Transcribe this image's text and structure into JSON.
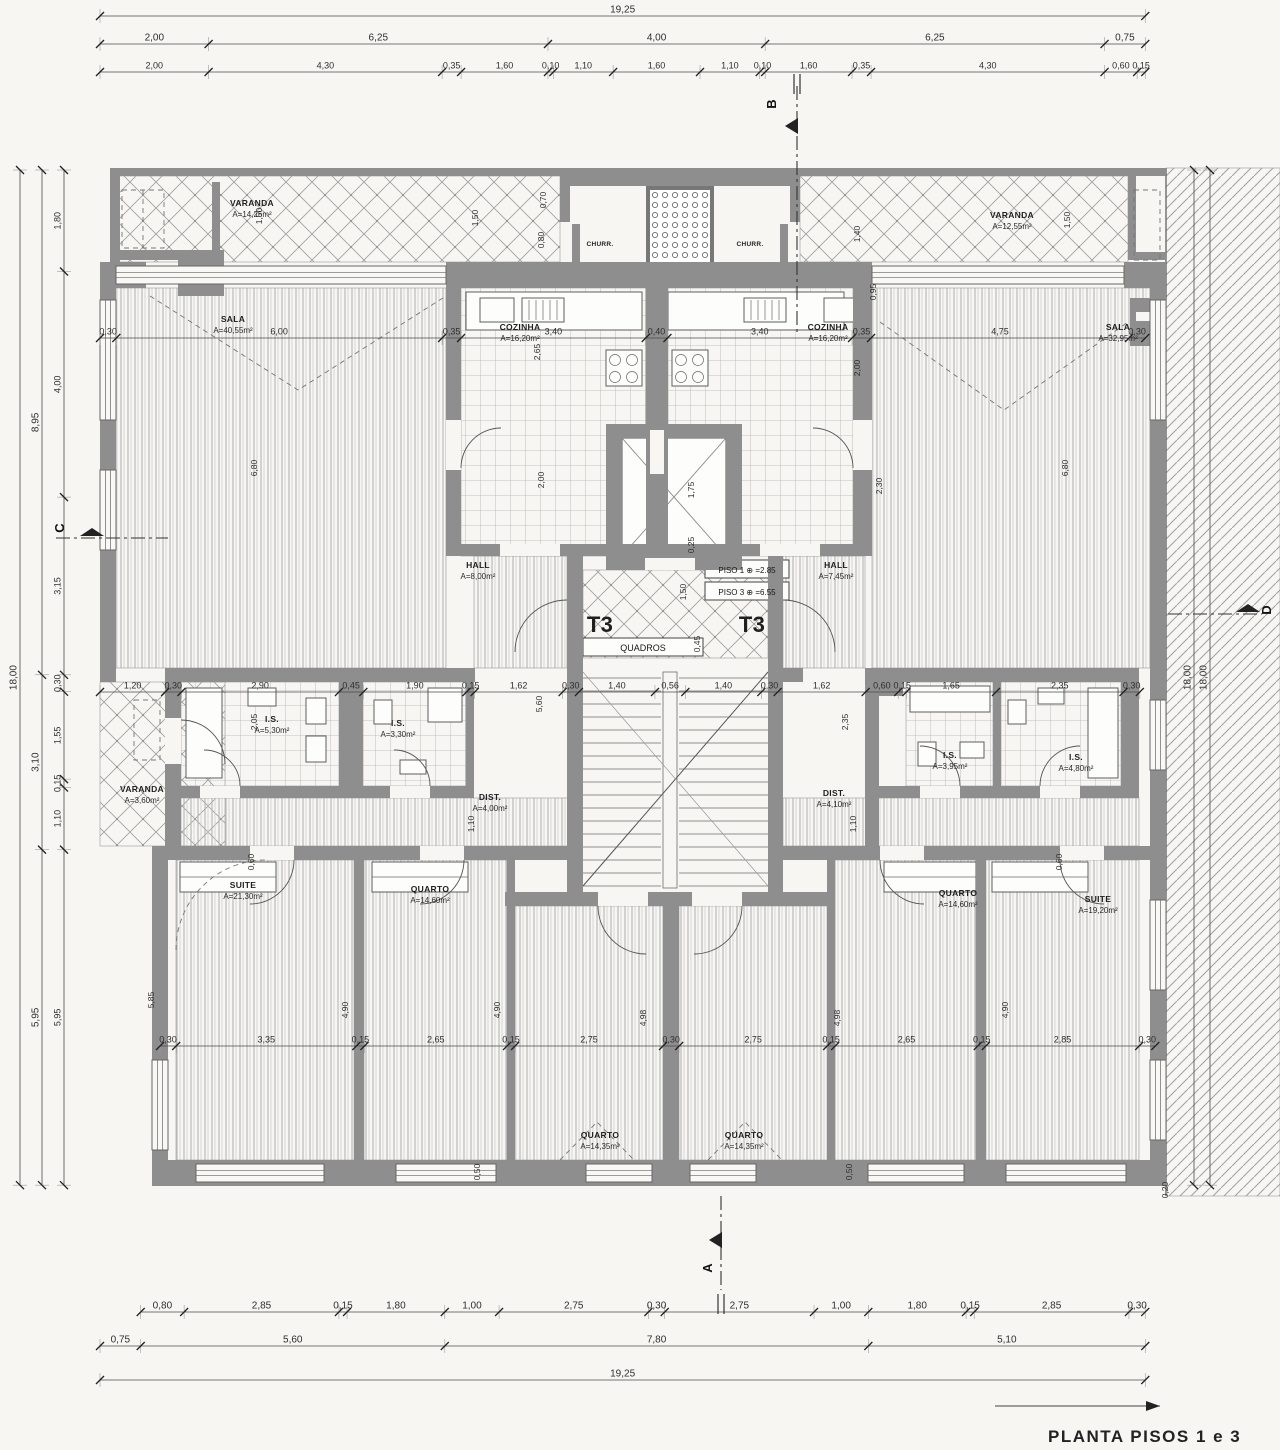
{
  "title": "PLANTA PISOS 1 e 3",
  "colors": {
    "paper": "#f7f6f3",
    "ink": "#3a3a3a",
    "wall": "#8e8e8e",
    "hatch": "#a3a3a3"
  },
  "section_markers": {
    "top": "B",
    "bottom": "A",
    "left": "C",
    "right": "D"
  },
  "core_labels": {
    "t3_left": "T3",
    "t3_right": "T3",
    "quadros": "QUADROS",
    "piso1": "PISO 1 ⊕ =2.85",
    "piso3": "PISO 3 ⊕ =6.55"
  },
  "rooms": {
    "varanda_tl": {
      "name": "VARANDA",
      "area": "A=14,25m²"
    },
    "varanda_tr": {
      "name": "VARANDA",
      "area": "A=12,55m²"
    },
    "sala_l": {
      "name": "SALA",
      "area": "A=40,55m²"
    },
    "sala_r": {
      "name": "SALA",
      "area": "A=32,95m²"
    },
    "cozinha_l": {
      "name": "COZINHA",
      "area": "A=16,20m²"
    },
    "cozinha_r": {
      "name": "COZINHA",
      "area": "A=16,20m²"
    },
    "churr_l": {
      "name": "CHURR."
    },
    "churr_r": {
      "name": "CHURR."
    },
    "hall_l": {
      "name": "HALL",
      "area": "A=8,00m²"
    },
    "hall_r": {
      "name": "HALL",
      "area": "A=7,45m²"
    },
    "is_l1": {
      "name": "I.S.",
      "area": "A=5,30m²"
    },
    "is_l2": {
      "name": "I.S.",
      "area": "A=3,30m²"
    },
    "is_r1": {
      "name": "I.S.",
      "area": "A=3,95m²"
    },
    "is_r2": {
      "name": "I.S.",
      "area": "A=4,80m²"
    },
    "varanda_ml": {
      "name": "VARANDA",
      "area": "A=3,60m²"
    },
    "dist_l": {
      "name": "DIST.",
      "area": "A=4,00m²"
    },
    "dist_r": {
      "name": "DIST.",
      "area": "A=4,10m²"
    },
    "suite_l": {
      "name": "SUITE",
      "area": "A=21,30m²"
    },
    "suite_r": {
      "name": "SUITE",
      "area": "A=19,20m²"
    },
    "quarto_l1": {
      "name": "QUARTO",
      "area": "A=14,60m²"
    },
    "quarto_c1": {
      "name": "QUARTO",
      "area": "A=14,35m²"
    },
    "quarto_c2": {
      "name": "QUARTO",
      "area": "A=14,35m²"
    },
    "quarto_r1": {
      "name": "QUARTO",
      "area": "A=14,60m²"
    }
  },
  "dim_chains": {
    "top1": [
      "19,25"
    ],
    "top2": [
      "2,00",
      "6,25",
      "4,00",
      "6,25",
      "0,75"
    ],
    "top3": [
      "2,00",
      "4,30",
      "0,35",
      "1,60",
      "0,10",
      "1,10",
      "1,60",
      "1,10",
      "0,10",
      "1,60",
      "0,35",
      "4,30",
      "0,60",
      "0,15"
    ],
    "mid_sala": [
      "0,30",
      "6,00",
      "0,35",
      "3,40",
      "0,40",
      "3,40",
      "0,35",
      "4,75",
      "0,30"
    ],
    "mid_band": [
      "1,20",
      "0,30",
      "2,90",
      "0,45",
      "1,90",
      "0,15",
      "1,62",
      "0,30",
      "1,40",
      "0,56",
      "1,40",
      "0,30",
      "1,62",
      "0,60",
      "0,15",
      "1,65",
      "2,35",
      "0,30"
    ],
    "bottom_band": [
      "0,30",
      "3,35",
      "0,15",
      "2,65",
      "0,15",
      "2,75",
      "0,30",
      "2,75",
      "0,15",
      "2,65",
      "0,15",
      "2,85",
      "0,30"
    ],
    "bottom1": [
      "0,80",
      "2,85",
      "0,15",
      "1,80",
      "1,00",
      "2,75",
      "0,30",
      "2,75",
      "1,00",
      "1,80",
      "0,15",
      "2,85",
      "0,30"
    ],
    "bottom2": [
      "0,75",
      "5,60",
      "7,80",
      "5,10"
    ],
    "bottom3": [
      "19,25"
    ],
    "left_inner": [
      "1,80",
      "4,00",
      "3,15",
      "0,30",
      "1,55",
      "0,15",
      "1,10",
      "5,95"
    ],
    "left_mid": [
      "8,95",
      "3,10",
      "5,95"
    ],
    "left_outer": [
      "18,00"
    ],
    "right1": [
      "18,00"
    ],
    "right2": [
      "18,00"
    ]
  },
  "annotations": [
    {
      "t": "1,50",
      "x": 262,
      "y": 216
    },
    {
      "t": "1,50",
      "x": 478,
      "y": 218
    },
    {
      "t": "0,70",
      "x": 546,
      "y": 200
    },
    {
      "t": "0,80",
      "x": 544,
      "y": 240
    },
    {
      "t": "1,50",
      "x": 1070,
      "y": 220
    },
    {
      "t": "1,40",
      "x": 860,
      "y": 234
    },
    {
      "t": "0,95",
      "x": 876,
      "y": 292
    },
    {
      "t": "2,00",
      "x": 860,
      "y": 368
    },
    {
      "t": "6,80",
      "x": 257,
      "y": 468
    },
    {
      "t": "2,00",
      "x": 544,
      "y": 480
    },
    {
      "t": "2,30",
      "x": 882,
      "y": 486
    },
    {
      "t": "6,80",
      "x": 1068,
      "y": 468
    },
    {
      "t": "1,75",
      "x": 694,
      "y": 490
    },
    {
      "t": "0,25",
      "x": 694,
      "y": 545
    },
    {
      "t": "2,65",
      "x": 540,
      "y": 352
    },
    {
      "t": "1,50",
      "x": 686,
      "y": 592
    },
    {
      "t": "0,45",
      "x": 700,
      "y": 644
    },
    {
      "t": "5,60",
      "x": 542,
      "y": 704
    },
    {
      "t": "2,05",
      "x": 257,
      "y": 722
    },
    {
      "t": "2,35",
      "x": 848,
      "y": 722
    },
    {
      "t": "1,10",
      "x": 474,
      "y": 824
    },
    {
      "t": "1,10",
      "x": 856,
      "y": 824
    },
    {
      "t": "5,85",
      "x": 154,
      "y": 1000
    },
    {
      "t": "4,90",
      "x": 348,
      "y": 1010
    },
    {
      "t": "4,90",
      "x": 500,
      "y": 1010
    },
    {
      "t": "4,98",
      "x": 646,
      "y": 1018
    },
    {
      "t": "4,98",
      "x": 840,
      "y": 1018
    },
    {
      "t": "4,90",
      "x": 1008,
      "y": 1010
    },
    {
      "t": "0,60",
      "x": 254,
      "y": 862
    },
    {
      "t": "0,60",
      "x": 1062,
      "y": 862
    },
    {
      "t": "0,50",
      "x": 480,
      "y": 1172
    },
    {
      "t": "0,50",
      "x": 852,
      "y": 1172
    },
    {
      "t": "0,20",
      "x": 1168,
      "y": 1190
    }
  ]
}
